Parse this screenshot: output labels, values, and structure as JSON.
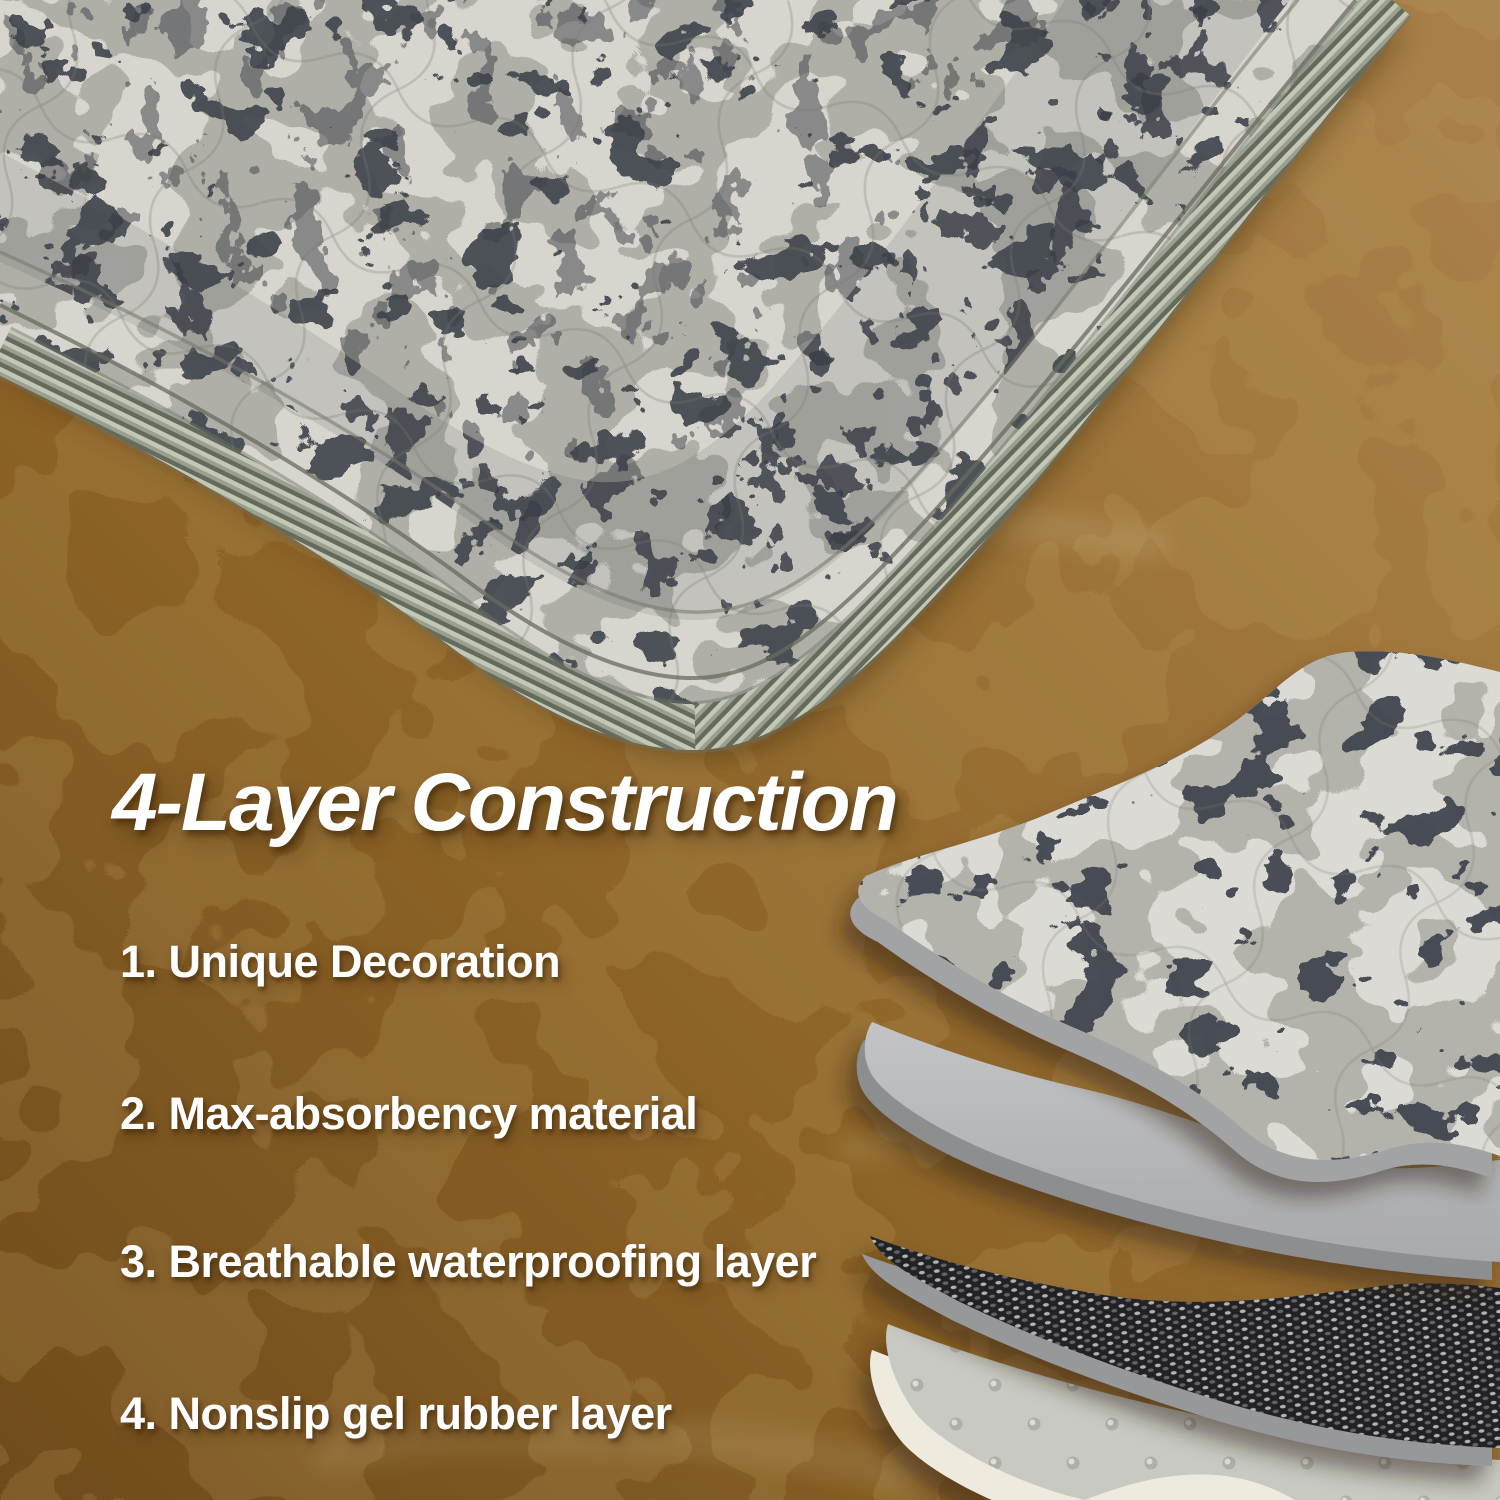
{
  "content": {
    "heading": "4-Layer Construction",
    "list_items": [
      {
        "label": "1. Unique Decoration"
      },
      {
        "label": "2. Max-absorbency material"
      },
      {
        "label": "3. Breathable waterproofing layer"
      },
      {
        "label": "4. Nonslip gel rubber layer"
      }
    ]
  },
  "colors": {
    "text": "#ffffff",
    "floor-light": "#c79a5c",
    "floor-dark": "#7a5220",
    "mat-base": "#d8d5ce",
    "mat-print-dark": "#42474f",
    "mat-print-mid": "#a9a8a1",
    "serge-trim": "#8f9585",
    "layer1-edge": "#a2a3a5",
    "layer2-gray": "#b6b7b9",
    "layer2-edge": "#8d8e90",
    "layer3-dark": "#232428",
    "layer4-light": "#c8c9c3",
    "layer4-rim": "#eeeade"
  }
}
